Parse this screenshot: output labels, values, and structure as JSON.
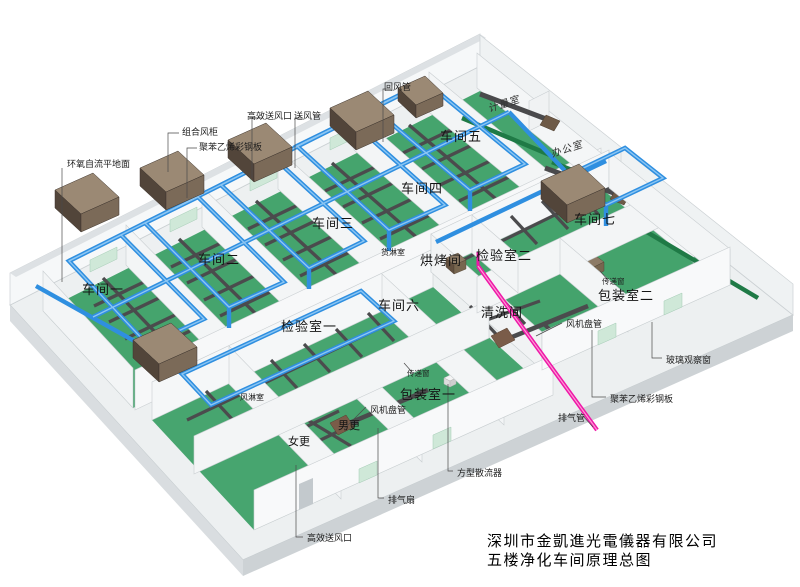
{
  "title_block": {
    "line1": "深圳市金凱進光電儀器有限公司",
    "line2": "五楼净化车间原理总图"
  },
  "rooms": {
    "workshop1": "车间一",
    "workshop2": "车间二",
    "workshop3": "车间三",
    "workshop4": "车间四",
    "workshop5": "车间五",
    "workshop6": "车间六",
    "workshop7": "车间七",
    "inspection1": "检验室一",
    "inspection2": "检验室二",
    "baking": "烘烤间",
    "cleaning": "清洗间",
    "cargo_shower": "货淋室",
    "air_shower": "风淋室",
    "women": "女更",
    "men": "男更",
    "packing1": "包装室一",
    "packing2": "包装室二",
    "metering": "计量室",
    "office": "办公室"
  },
  "callouts": {
    "epoxy_floor": "环氧自流平地面",
    "combined_ahu": "组合风柜",
    "panel_left": "聚苯乙烯彩钢板",
    "hepa_top": "高效送风口",
    "supply_duct": "送风管",
    "return_duct": "回风管",
    "pass_window_center": "传递窗",
    "pass_window_right": "传递窗",
    "fan_coil_right": "风机盘管",
    "fan_coil_bottom": "风机盘管",
    "glass_window": "玻璃观察窗",
    "panel_right": "聚苯乙烯彩钢板",
    "exhaust_pipe": "排气管",
    "square_diffuser": "方型散流器",
    "exhaust_fan": "排气扇",
    "hepa_bottom": "高效送风口"
  },
  "colors": {
    "supply_duct_blue": "#2f8fe0",
    "exhaust_pink": "#ee18a8",
    "floor_green": "#45a46d",
    "conveyor_green": "#1f7a46",
    "ahu_brown": "#9b8974",
    "wall_white": "#f5f7f8"
  }
}
